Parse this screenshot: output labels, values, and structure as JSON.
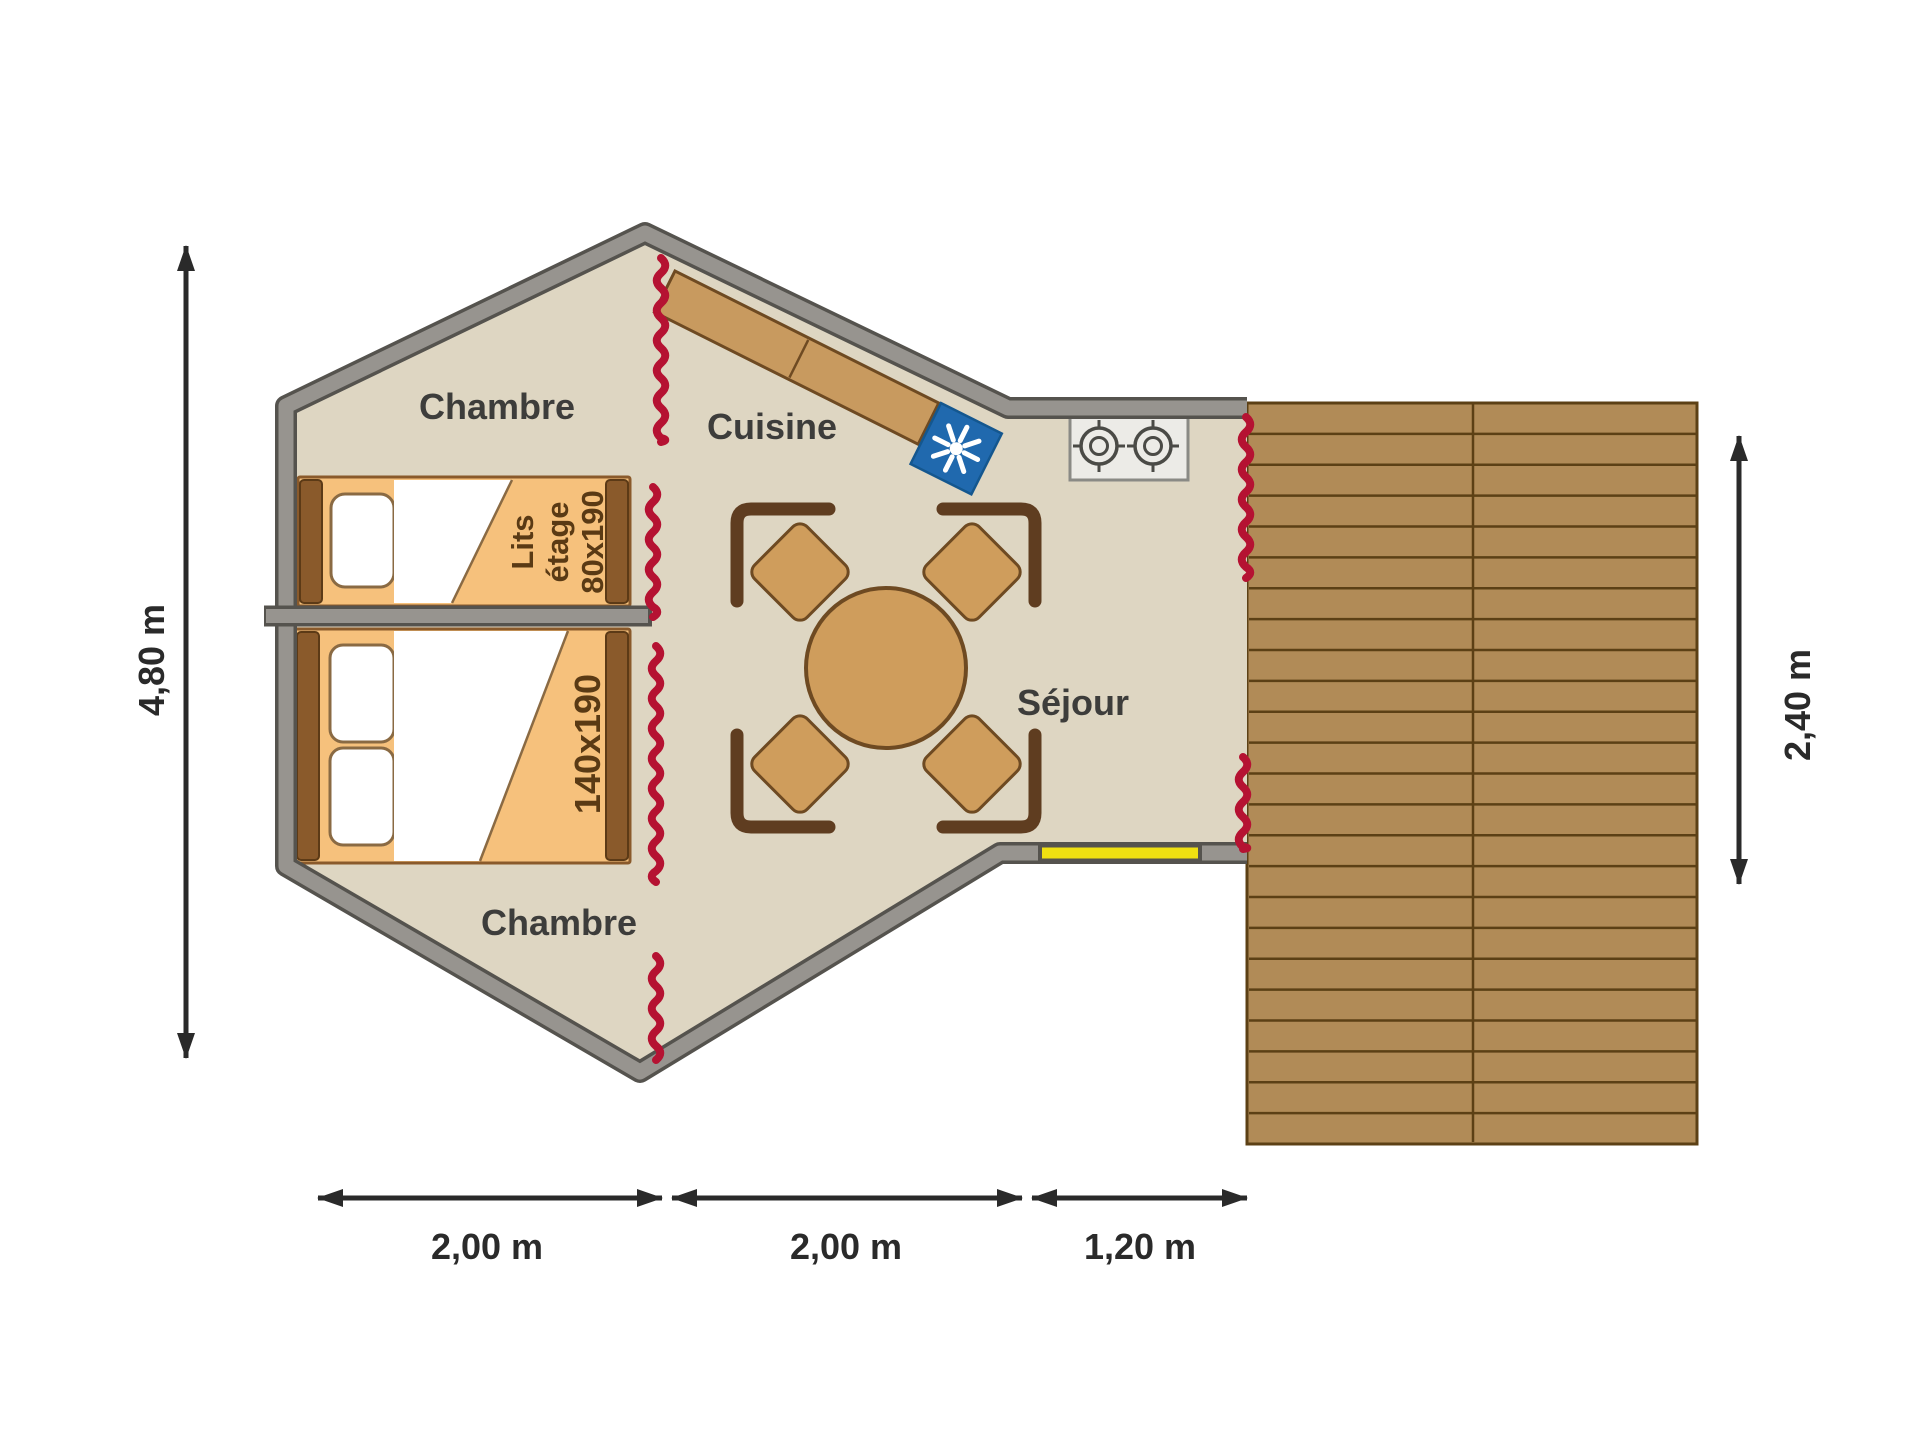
{
  "plan": {
    "rooms": {
      "bedroom_top": "Chambre",
      "kitchen": "Cuisine",
      "living": "Séjour",
      "bedroom_bottom": "Chambre"
    },
    "beds": {
      "bunk_line1": "Lits",
      "bunk_line2": "étage",
      "bunk_line3": "80x190",
      "double": "140x190"
    },
    "dimensions": {
      "overall_height": "4,80 m",
      "bedrooms_width": "2,00 m",
      "living_width": "2,00 m",
      "entry_width": "1,20 m",
      "terrace_depth": "2,40 m"
    },
    "icons": {
      "fridge": "snowflake-icon",
      "stove": "two-burner-stove-icon",
      "zipper": "zipper-opening-marker"
    },
    "colors": {
      "floor": "#ded6c2",
      "wall": "#97948f",
      "wall_edge": "#55534e",
      "counter": "#c89a5f",
      "wood_edge": "#6e4a22",
      "deck": "#b18b57",
      "deck_line": "#5c4015",
      "bed": "#f6c17c",
      "bed_frame": "#8a5a2b",
      "bed_frame_edge": "#5c3a16",
      "pillow": "#ffffff",
      "pillow_edge": "#8a6a43",
      "zipper": "#b51232",
      "fridge": "#2069ae",
      "fridge_edge": "#14578f",
      "door": "#efe011",
      "table": "#cf9d5c",
      "chair_back": "#5f3d20",
      "stove": "#ecebe7",
      "stove_edge": "#8a8a85",
      "burner": "#4a4a46",
      "room_label": "#3d3d3b",
      "bed_label": "#5a3a14",
      "dim": "#2a2a2a",
      "background": "#ffffff"
    }
  }
}
